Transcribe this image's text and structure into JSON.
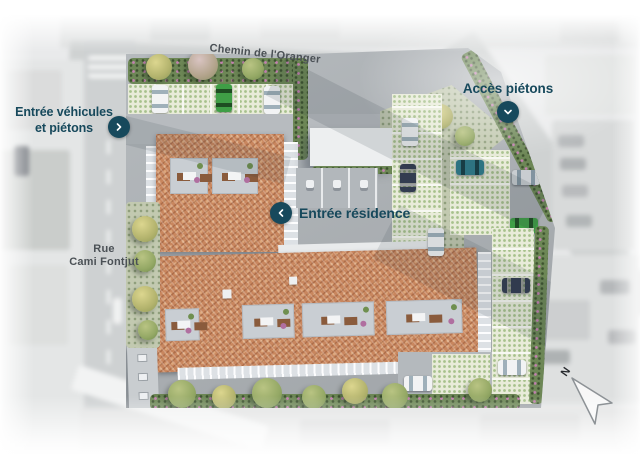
{
  "plan": {
    "streets": {
      "top_label": "Chemin de l'Oranger",
      "left_label_line1": "Rue",
      "left_label_line2": "Cami Fontjut"
    },
    "markers": {
      "vehicle_entrance": {
        "line1": "Entrée véhicules",
        "line2": "et piétons",
        "icon": "chevron-right-icon"
      },
      "pedestrian_access": {
        "label": "Accès piétons",
        "icon": "chevron-down-icon"
      },
      "residence_entrance": {
        "label": "Entrée résidence",
        "icon": "chevron-left-icon"
      }
    },
    "compass": {
      "label": "N",
      "icon": "north-arrow-icon"
    },
    "colors": {
      "accent_teal": "#17495c",
      "street_label_gray": "#4b5156",
      "roof_terracotta": "#c8865e",
      "hedge_green": "#6d8756",
      "paver_dot_green": "#a7c18c",
      "flower_pink": "#c37fb5",
      "plan_road_gray": "#adb2b6"
    }
  }
}
